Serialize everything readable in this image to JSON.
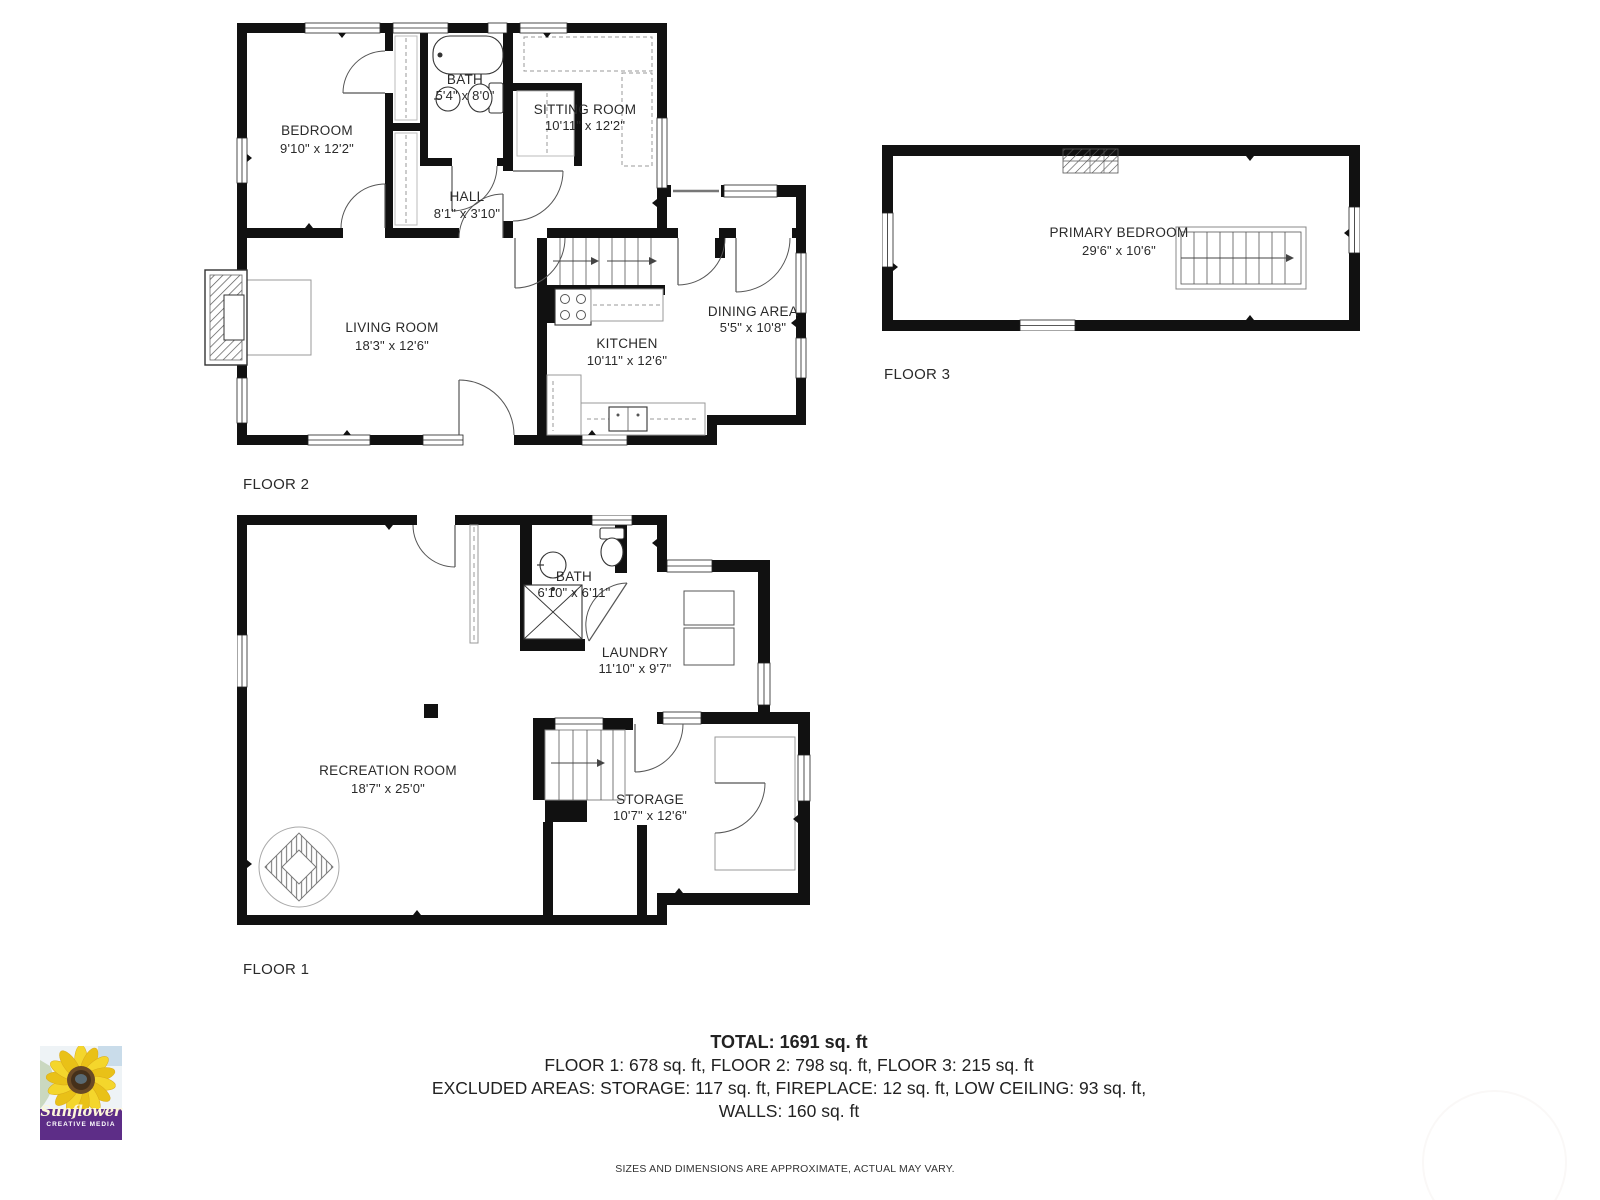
{
  "floors": [
    {
      "label": "FLOOR 1",
      "rooms": [
        {
          "name": "RECREATION ROOM",
          "dims": "18'7\" x 25'0\""
        },
        {
          "name": "BATH",
          "dims": "6'10\" x 6'11\""
        },
        {
          "name": "LAUNDRY",
          "dims": "11'10\" x 9'7\""
        },
        {
          "name": "STORAGE",
          "dims": "10'7\" x 12'6\""
        }
      ]
    },
    {
      "label": "FLOOR 2",
      "rooms": [
        {
          "name": "BEDROOM",
          "dims": "9'10\" x 12'2\""
        },
        {
          "name": "BATH",
          "dims": "5'4\" x 8'0\""
        },
        {
          "name": "SITTING ROOM",
          "dims": "10'11\" x 12'2\""
        },
        {
          "name": "HALL",
          "dims": "8'1\" x 3'10\""
        },
        {
          "name": "LIVING ROOM",
          "dims": "18'3\" x 12'6\""
        },
        {
          "name": "KITCHEN",
          "dims": "10'11\" x 12'6\""
        },
        {
          "name": "DINING AREA",
          "dims": "5'5\" x 10'8\""
        }
      ]
    },
    {
      "label": "FLOOR 3",
      "rooms": [
        {
          "name": "PRIMARY BEDROOM",
          "dims": "29'6\" x 10'6\""
        }
      ]
    }
  ],
  "summary": {
    "total": "TOTAL: 1691 sq. ft",
    "floors_line": "FLOOR 1: 678 sq. ft, FLOOR 2: 798 sq. ft, FLOOR 3: 215 sq. ft",
    "excluded_line": "EXCLUDED AREAS: STORAGE: 117 sq. ft, FIREPLACE: 12 sq. ft, LOW CEILING: 93 sq. ft,",
    "walls_line": "WALLS: 160 sq. ft",
    "disclaimer": "SIZES AND DIMENSIONS ARE APPROXIMATE, ACTUAL MAY VARY."
  },
  "logo": {
    "brand": "Sunflower",
    "tagline": "CREATIVE MEDIA",
    "band_color": "#5d2d87"
  },
  "colors": {
    "wall": "#111111",
    "thin_line": "#555555"
  }
}
